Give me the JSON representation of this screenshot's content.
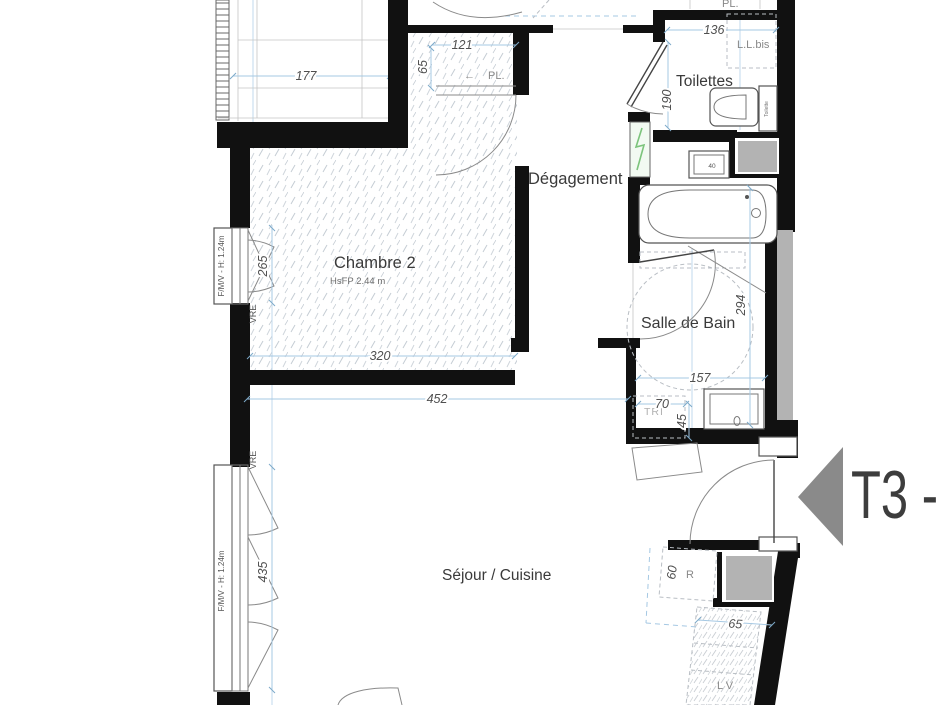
{
  "meta": {
    "type": "floor-plan",
    "unit_type_label": "T3 -"
  },
  "rooms": {
    "chambre2": {
      "name": "Chambre 2",
      "sub": "HsFP 2.44 m"
    },
    "degagement": {
      "name": "Dégagement"
    },
    "toilettes": {
      "name": "Toilettes"
    },
    "salle_de_bain": {
      "name": "Salle de Bain"
    },
    "sejour_cuisine": {
      "name": "Séjour / Cuisine"
    },
    "placard": {
      "name": "PL.",
      "arrow": "←"
    },
    "placard_top": {
      "name": "PL."
    }
  },
  "dimensions": {
    "w177": "177",
    "w121": "121",
    "h65": "65",
    "w136": "136",
    "h190": "190",
    "h265": "265",
    "w320": "320",
    "w452": "452",
    "h294": "294",
    "w157": "157",
    "w70": "70",
    "h45": "45",
    "h435": "435",
    "h60": "60",
    "w65_kitchen": "65"
  },
  "annotations": {
    "ll_bis": "L.L.bis",
    "toilette_tank": "Toilette",
    "tri": "TRI",
    "sink_width": "40",
    "vre_top": "VRE",
    "vre_bottom": "VRE",
    "window_top": "F/M/V - H: 1.24m",
    "window_bottom": "F/M/V - H: 1.24m",
    "fridge": "R",
    "dishwasher": "L V"
  },
  "colors": {
    "wall": "#111111",
    "dimension_blue": "#a5c8e3",
    "shaft_gray": "#b3b3b3",
    "arrow_gray": "#8a8a8a",
    "panel_green": "#7cc47c",
    "label": "#3a3a3a"
  }
}
